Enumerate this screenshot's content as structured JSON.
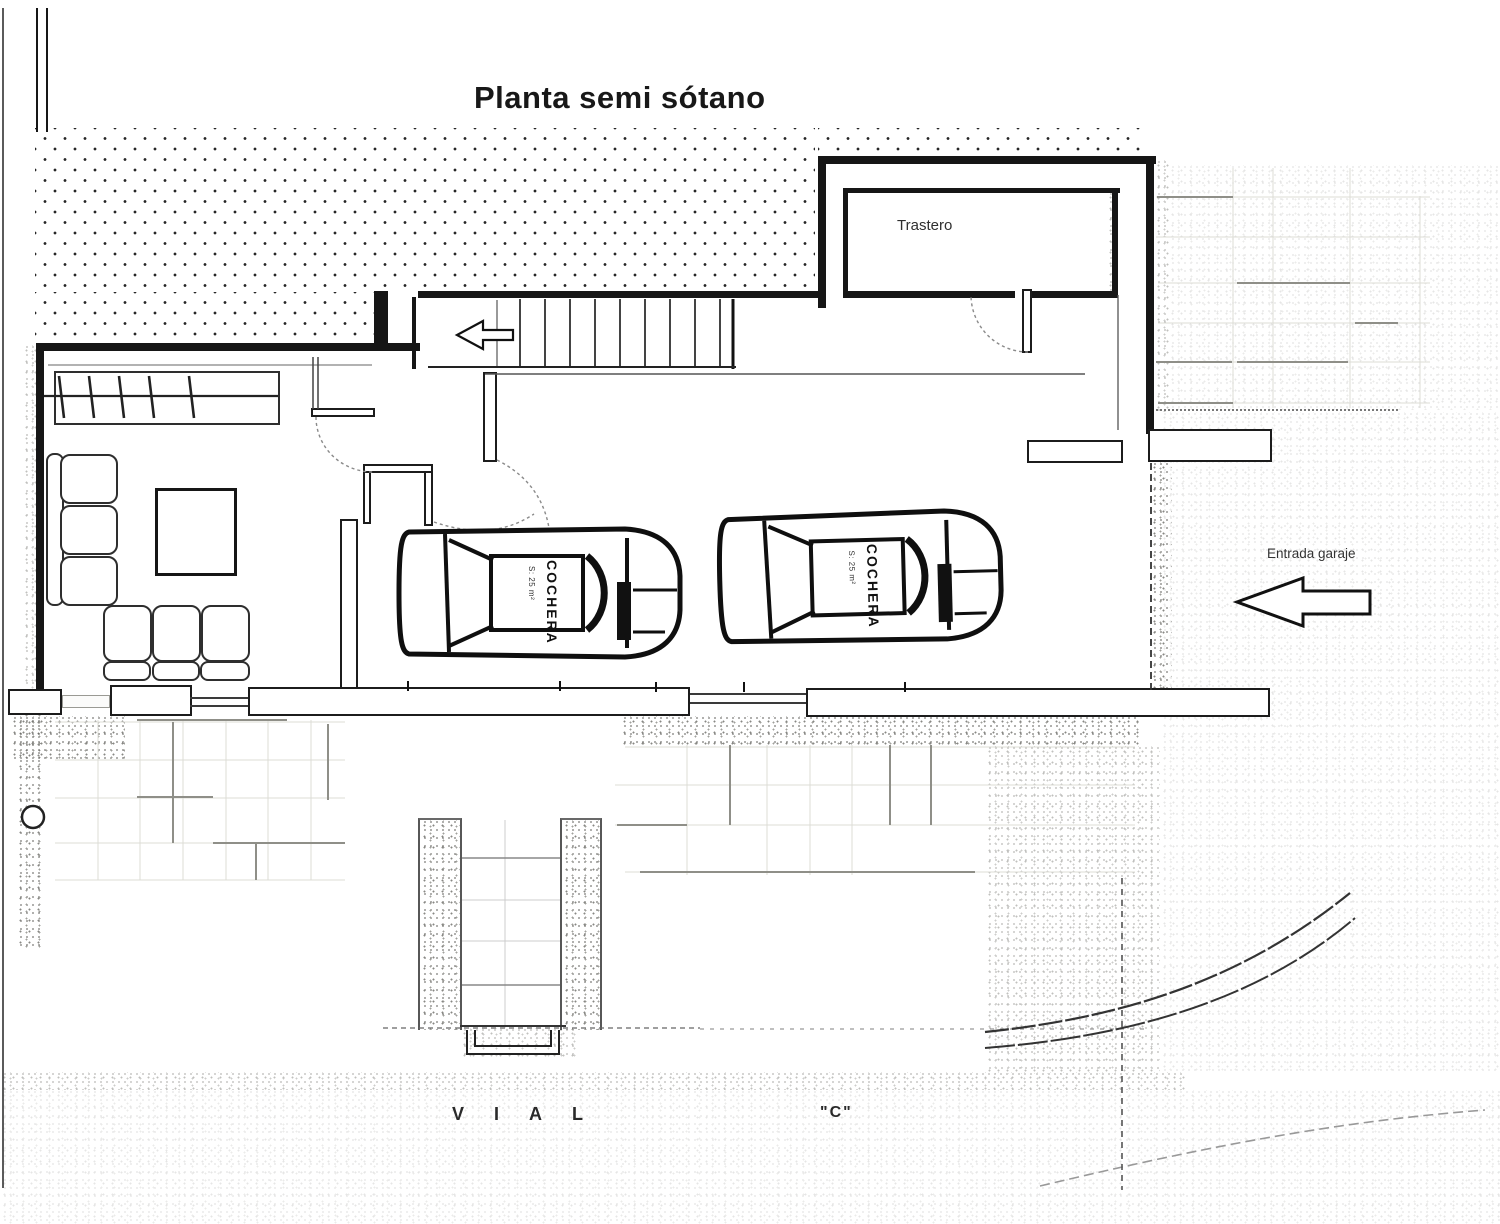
{
  "title": "Planta semi sótano",
  "rooms": {
    "storage": "Trastero"
  },
  "annotations": {
    "garage_entrance": "Entrada garaje",
    "street_name": "VIAL",
    "street_designation": "\"C\"",
    "parking_spot": "COCHERA",
    "parking_spot_area": "S: 25 m²"
  },
  "icons": {
    "stairs_arrow": "arrow-left",
    "entrance_arrow": "arrow-left"
  },
  "colors": {
    "ink": "#1a1a1a",
    "wall": "#161616",
    "grid_faint": "#dcdcd6",
    "grid_mid": "#8f8f88",
    "paper": "#ffffff"
  }
}
